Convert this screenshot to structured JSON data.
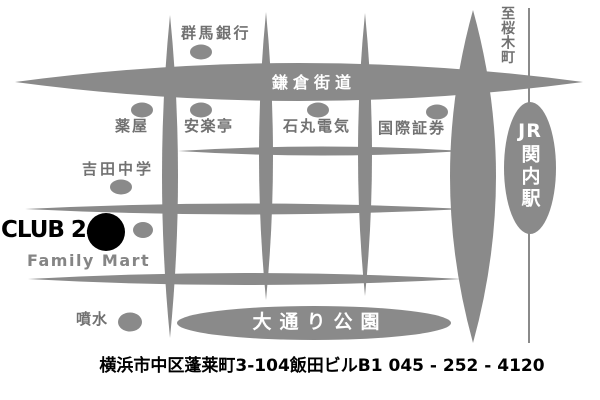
{
  "map": {
    "labels": {
      "gunma_bank": "群馬銀行",
      "to_sakuragicho": "至桜木町",
      "kamakura_kaido": "鎌倉街道",
      "pharmacy": "薬屋",
      "anrakutei": "安楽亭",
      "ishimaru_denki": "石丸電気",
      "kokusai_shoken": "国際証券",
      "station_jr": "JR",
      "station_kannai": "関内駅",
      "yoshida_junior_high": "吉田中学",
      "club24": "CLUB 24",
      "family_mart": "Family Mart",
      "fountain": "噴水",
      "odori_park": "大通り公園"
    },
    "address": "横浜市中区蓬莱町3-104飯田ビルB1 045 - 252 - 4120",
    "colors": {
      "road_gray": "#8a8a8a",
      "label_gray": "#717171",
      "marker_black": "#000000",
      "road_text_white": "#ffffff"
    }
  }
}
